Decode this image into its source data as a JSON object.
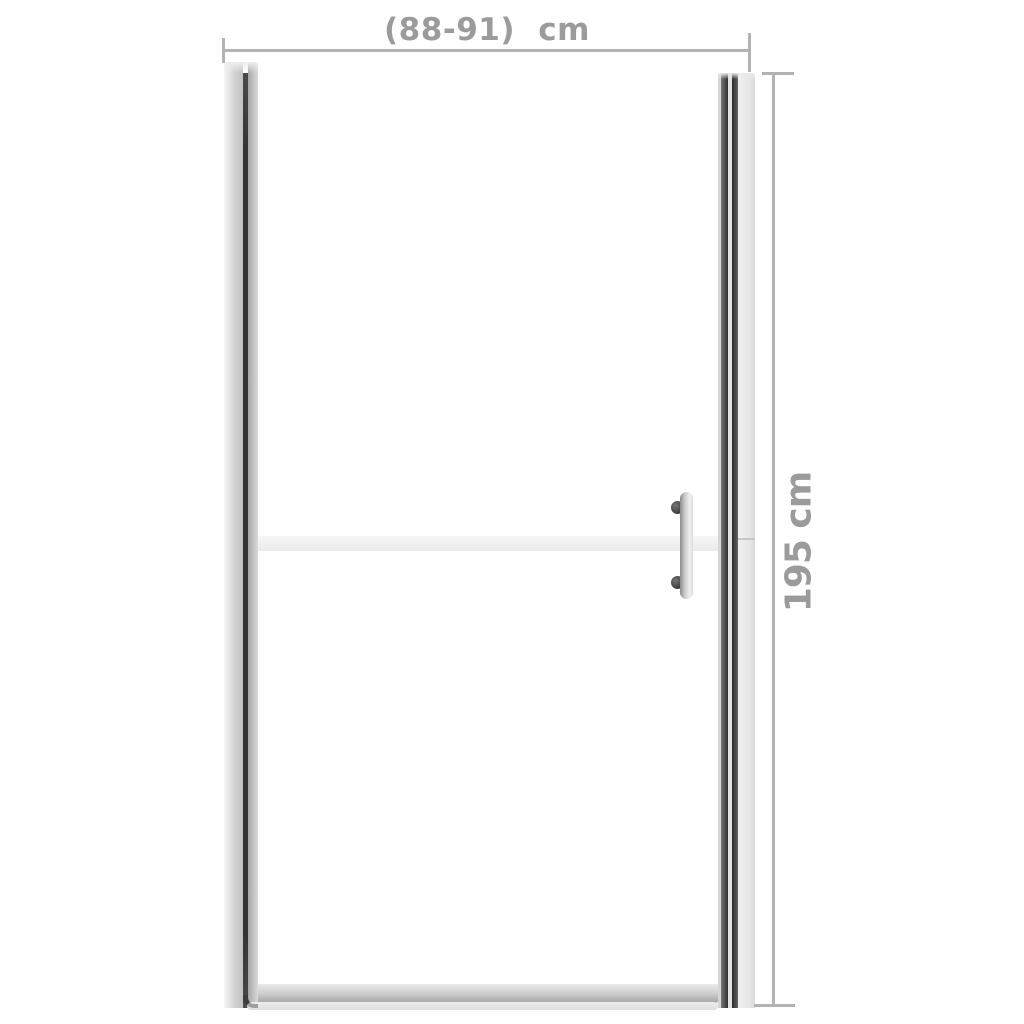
{
  "diagram": {
    "title": "Shower door front-view dimension diagram",
    "width_dimension": {
      "label": "(88-91) cm",
      "orientation": "horizontal"
    },
    "height_dimension": {
      "label": "195 cm",
      "orientation": "vertical"
    }
  },
  "colors": {
    "background": "#ffffff",
    "dimension_line": "#b3b3b3",
    "dimension_text": "#9b9b9b",
    "profile_dark_stripe": "#343434",
    "profile_light": "#e5e5e5",
    "frosted_band": "#f1f1f1",
    "handle_knob": "#4a4a4a",
    "bottom_rail": "#c0c0c0"
  }
}
